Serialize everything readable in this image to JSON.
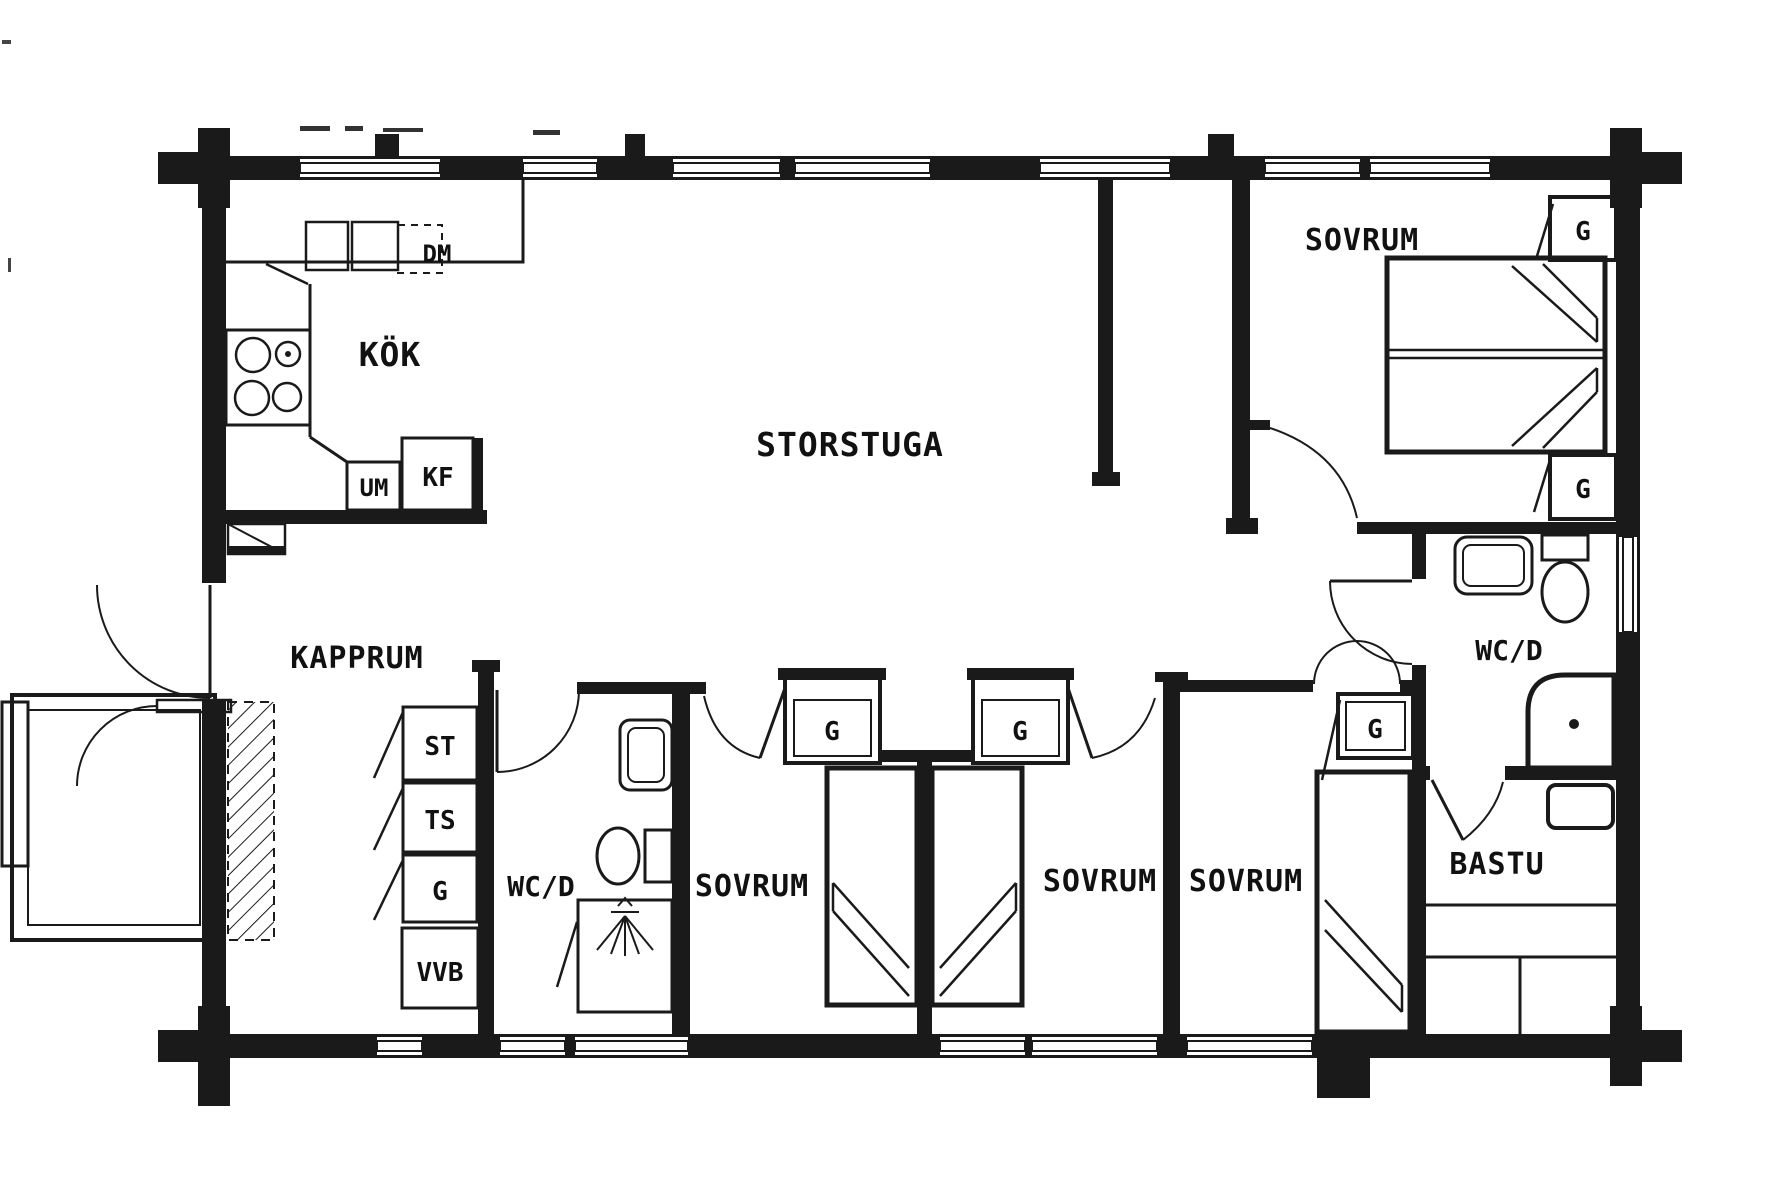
{
  "colors": {
    "ink": "#1a1a1a",
    "paper": "#ffffff"
  },
  "rooms": {
    "storstuga": {
      "label": "STORSTUGA"
    },
    "kok": {
      "label": "KÖK"
    },
    "kapprum": {
      "label": "KAPPRUM"
    },
    "sovrum_ne": {
      "label": "SOVRUM"
    },
    "sovrum_1": {
      "label": "SOVRUM"
    },
    "sovrum_2": {
      "label": "SOVRUM"
    },
    "sovrum_3": {
      "label": "SOVRUM"
    },
    "wcd_left": {
      "label": "WC/D"
    },
    "wcd_right": {
      "label": "WC/D"
    },
    "bastu": {
      "label": "BASTU"
    }
  },
  "closets": {
    "st": {
      "label": "ST"
    },
    "ts": {
      "label": "TS"
    },
    "g_kapprum": {
      "label": "G"
    },
    "vvb": {
      "label": "VVB"
    },
    "g_sovrum_1": {
      "label": "G"
    },
    "g_sovrum_2": {
      "label": "G"
    },
    "g_sovrum_3": {
      "label": "G"
    },
    "g_sovrum_ne_top": {
      "label": "G"
    },
    "g_sovrum_ne_bottom": {
      "label": "G"
    }
  },
  "appliances": {
    "dm": {
      "label": "DM"
    },
    "um": {
      "label": "UM"
    },
    "kf": {
      "label": "KF"
    }
  }
}
